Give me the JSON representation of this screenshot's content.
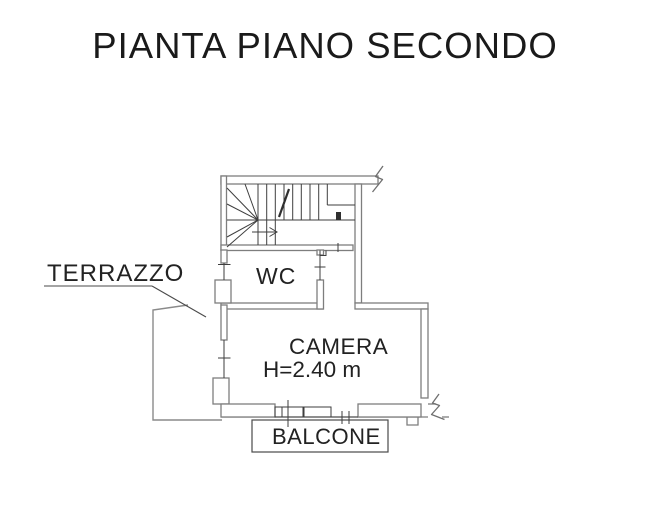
{
  "title": "PIANTA PIANO SECONDO",
  "plan": {
    "labels": {
      "terrazzo": "TERRAZZO",
      "wc": "WC",
      "camera": "CAMERA",
      "camera_height": "H=2.40 m",
      "balcone": "BALCONE"
    },
    "colors": {
      "background": "#ffffff",
      "wall_outline": "#7e7e7e",
      "detail_line": "#3e3e3e",
      "label_text": "#222222",
      "title_text": "#1a1a1a"
    }
  }
}
